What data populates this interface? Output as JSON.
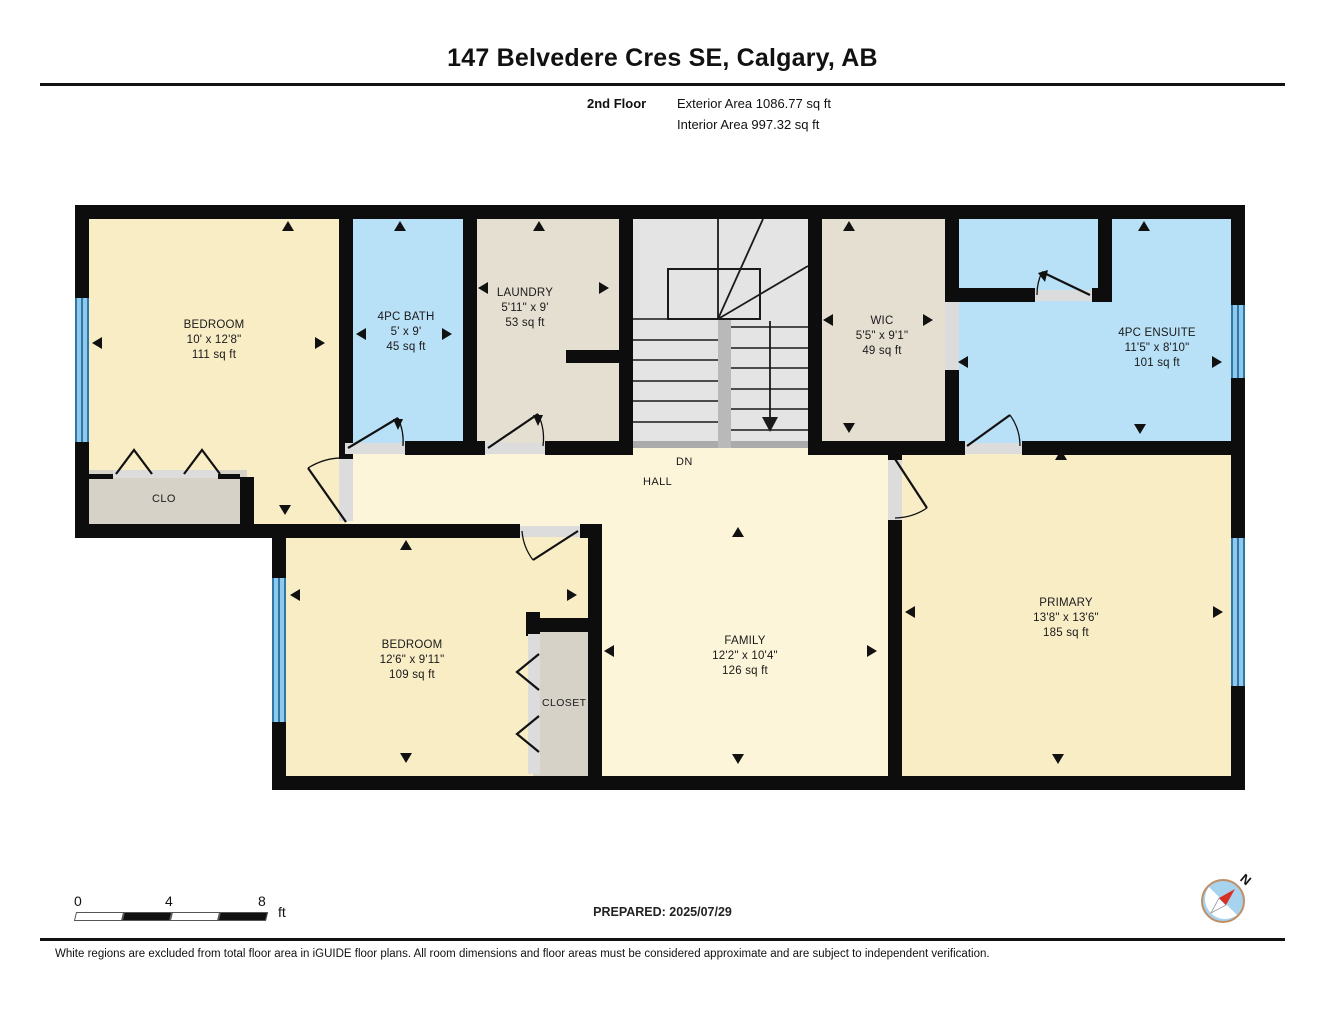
{
  "header": {
    "title": "147 Belvedere Cres SE, Calgary, AB",
    "floor_label": "2nd Floor",
    "exterior_area": "Exterior Area 1086.77 sq ft",
    "interior_area": "Interior Area 997.32 sq ft"
  },
  "rooms": {
    "bedroom1": {
      "name": "BEDROOM",
      "dims": "10' x 12'8\"",
      "area": "111 sq ft"
    },
    "bath": {
      "name": "4PC BATH",
      "dims": "5' x 9'",
      "area": "45 sq ft"
    },
    "laundry": {
      "name": "LAUNDRY",
      "dims": "5'11\" x 9'",
      "area": "53 sq ft"
    },
    "wic": {
      "name": "WIC",
      "dims": "5'5\" x 9'1\"",
      "area": "49 sq ft"
    },
    "ensuite": {
      "name": "4PC ENSUITE",
      "dims": "11'5\" x 8'10\"",
      "area": "101 sq ft"
    },
    "clo": {
      "name": "CLO"
    },
    "hall": {
      "name": "HALL"
    },
    "stairs_direction": "DN",
    "bedroom2": {
      "name": "BEDROOM",
      "dims": "12'6\" x 9'11\"",
      "area": "109 sq ft"
    },
    "closet": {
      "name": "CLOSET"
    },
    "family": {
      "name": "FAMILY",
      "dims": "12'2\" x 10'4\"",
      "area": "126 sq ft"
    },
    "primary": {
      "name": "PRIMARY",
      "dims": "13'8\" x 13'6\"",
      "area": "185 sq ft"
    }
  },
  "footer": {
    "scale": {
      "tick0": "0",
      "tick1": "4",
      "tick2": "8",
      "unit": "ft"
    },
    "prepared": "PREPARED: 2025/07/29",
    "compass_label": "N",
    "disclaimer": "White regions are excluded from total floor area in iGUIDE floor plans. All room dimensions and floor areas must be considered approximate and are subject to independent verification."
  },
  "colors": {
    "room_cream": "#f9edc6",
    "hall_cream": "#fdf5d9",
    "wet_blue": "#b8e0f6",
    "utility_tan": "#e5dfd2",
    "closet_gray": "#d6d2c8",
    "stairs_gray": "#e4e4e4",
    "wall_black": "#0d0d0d",
    "window_blue": "#2f77a6"
  }
}
